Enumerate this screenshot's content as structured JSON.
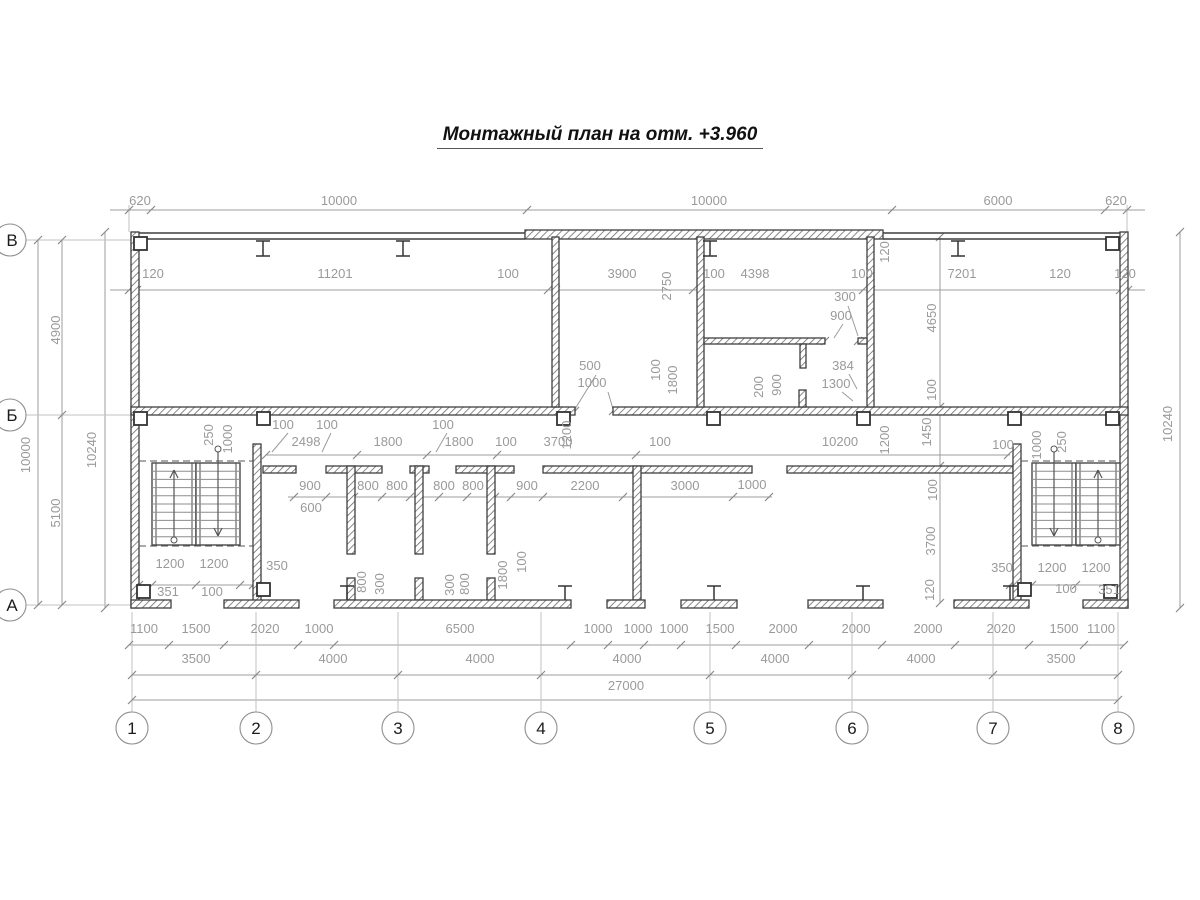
{
  "title": "Монтажный план на отм. +3.960",
  "colors": {
    "wall": "#3f3f3f",
    "dim": "#9c9c9c",
    "dim_text": "#9a9a9a",
    "bubble_stroke": "#8f8f8f",
    "bubble_text": "#1c1c1c",
    "stair": "#4a4a4a"
  },
  "axes": {
    "columns": [
      {
        "label": "1",
        "x": 132
      },
      {
        "label": "2",
        "x": 256
      },
      {
        "label": "3",
        "x": 398
      },
      {
        "label": "4",
        "x": 541
      },
      {
        "label": "5",
        "x": 710
      },
      {
        "label": "6",
        "x": 852
      },
      {
        "label": "7",
        "x": 993
      },
      {
        "label": "8",
        "x": 1118
      }
    ],
    "rows": [
      {
        "label": "В",
        "y": 240
      },
      {
        "label": "Б",
        "y": 415
      },
      {
        "label": "А",
        "y": 605
      }
    ],
    "bubble_row_y": 728,
    "bubble_col_x": 10,
    "bubble_r": 16
  },
  "dimension_labels": [
    [
      "620",
      140,
      205,
      0
    ],
    [
      "10000",
      339,
      205,
      0
    ],
    [
      "10000",
      709,
      205,
      0
    ],
    [
      "6000",
      998,
      205,
      0
    ],
    [
      "620",
      1116,
      205,
      0
    ],
    [
      "120",
      153,
      278,
      0
    ],
    [
      "11201",
      335,
      278,
      0
    ],
    [
      "100",
      508,
      278,
      0
    ],
    [
      "3900",
      622,
      278,
      0
    ],
    [
      "100",
      714,
      278,
      0
    ],
    [
      "4398",
      755,
      278,
      0
    ],
    [
      "100",
      862,
      278,
      0
    ],
    [
      "7201",
      962,
      278,
      0
    ],
    [
      "120",
      1060,
      278,
      0
    ],
    [
      "120",
      1125,
      278,
      0
    ],
    [
      "2750",
      671,
      286,
      1
    ],
    [
      "120",
      889,
      252,
      1
    ],
    [
      "300",
      845,
      301,
      0
    ],
    [
      "900",
      841,
      320,
      0
    ],
    [
      "100",
      660,
      370,
      1
    ],
    [
      "1800",
      677,
      380,
      1
    ],
    [
      "500",
      590,
      370,
      0
    ],
    [
      "1000",
      592,
      387,
      0
    ],
    [
      "200",
      763,
      387,
      1
    ],
    [
      "900",
      781,
      385,
      1
    ],
    [
      "384",
      843,
      370,
      0
    ],
    [
      "1300",
      836,
      388,
      0
    ],
    [
      "4900",
      60,
      330,
      1
    ],
    [
      "10000",
      30,
      455,
      1
    ],
    [
      "10240",
      96,
      450,
      1
    ],
    [
      "5100",
      60,
      513,
      1
    ],
    [
      "10240",
      1172,
      424,
      1
    ],
    [
      "4650",
      936,
      318,
      1
    ],
    [
      "100",
      936,
      390,
      1
    ],
    [
      "1450",
      931,
      432,
      1
    ],
    [
      "100",
      937,
      490,
      1
    ],
    [
      "3700",
      935,
      541,
      1
    ],
    [
      "120",
      934,
      590,
      1
    ],
    [
      "100",
      283,
      429,
      0
    ],
    [
      "100",
      327,
      429,
      0
    ],
    [
      "2498",
      306,
      446,
      0
    ],
    [
      "1800",
      388,
      446,
      0
    ],
    [
      "100",
      443,
      429,
      0
    ],
    [
      "1800",
      459,
      446,
      0
    ],
    [
      "100",
      506,
      446,
      0
    ],
    [
      "3700",
      558,
      446,
      0
    ],
    [
      "100",
      660,
      446,
      0
    ],
    [
      "10200",
      840,
      446,
      0
    ],
    [
      "100",
      1003,
      449,
      0
    ],
    [
      "250",
      213,
      435,
      1
    ],
    [
      "1000",
      232,
      439,
      1
    ],
    [
      "1200",
      571,
      435,
      1
    ],
    [
      "1200",
      889,
      440,
      1
    ],
    [
      "1000",
      1041,
      445,
      1
    ],
    [
      "250",
      1066,
      442,
      1
    ],
    [
      "900",
      310,
      490,
      0
    ],
    [
      "800",
      368,
      490,
      0
    ],
    [
      "800",
      397,
      490,
      0
    ],
    [
      "800",
      444,
      490,
      0
    ],
    [
      "800",
      473,
      490,
      0
    ],
    [
      "900",
      527,
      490,
      0
    ],
    [
      "2200",
      585,
      490,
      0
    ],
    [
      "3000",
      685,
      490,
      0
    ],
    [
      "1000",
      752,
      489,
      0
    ],
    [
      "600",
      311,
      512,
      0
    ],
    [
      "800",
      366,
      582,
      1
    ],
    [
      "300",
      384,
      584,
      1
    ],
    [
      "300",
      454,
      585,
      1
    ],
    [
      "800",
      469,
      584,
      1
    ],
    [
      "1800",
      507,
      575,
      1
    ],
    [
      "100",
      526,
      562,
      1
    ],
    [
      "1200",
      170,
      568,
      0
    ],
    [
      "1200",
      214,
      568,
      0
    ],
    [
      "350",
      277,
      570,
      0
    ],
    [
      "351",
      168,
      596,
      0
    ],
    [
      "100",
      212,
      596,
      0
    ],
    [
      "350",
      1002,
      572,
      0
    ],
    [
      "1200",
      1052,
      572,
      0
    ],
    [
      "1200",
      1096,
      572,
      0
    ],
    [
      "100",
      1066,
      593,
      0
    ],
    [
      "351",
      1109,
      594,
      0
    ],
    [
      "1100",
      144,
      633,
      0
    ],
    [
      "1500",
      196,
      633,
      0
    ],
    [
      "2020",
      265,
      633,
      0
    ],
    [
      "1000",
      319,
      633,
      0
    ],
    [
      "6500",
      460,
      633,
      0
    ],
    [
      "1000",
      598,
      633,
      0
    ],
    [
      "1000",
      638,
      633,
      0
    ],
    [
      "1000",
      674,
      633,
      0
    ],
    [
      "1500",
      720,
      633,
      0
    ],
    [
      "2000",
      783,
      633,
      0
    ],
    [
      "2000",
      856,
      633,
      0
    ],
    [
      "2000",
      928,
      633,
      0
    ],
    [
      "2020",
      1001,
      633,
      0
    ],
    [
      "1500",
      1064,
      633,
      0
    ],
    [
      "1100",
      1101,
      633,
      0
    ],
    [
      "3500",
      196,
      663,
      0
    ],
    [
      "4000",
      333,
      663,
      0
    ],
    [
      "4000",
      480,
      663,
      0
    ],
    [
      "4000",
      627,
      663,
      0
    ],
    [
      "4000",
      775,
      663,
      0
    ],
    [
      "4000",
      921,
      663,
      0
    ],
    [
      "3500",
      1061,
      663,
      0
    ],
    [
      "27000",
      626,
      690,
      0
    ]
  ],
  "dim_lines_h": [
    [
      110,
      1145,
      210
    ],
    [
      110,
      1145,
      290
    ],
    [
      266,
      1010,
      455
    ],
    [
      288,
      772,
      497
    ],
    [
      139,
      253,
      585
    ],
    [
      1010,
      1124,
      585
    ],
    [
      129,
      1124,
      645
    ],
    [
      132,
      1118,
      675
    ],
    [
      132,
      1118,
      700
    ]
  ],
  "dim_lines_v": [
    [
      240,
      605,
      38
    ],
    [
      240,
      605,
      62
    ],
    [
      232,
      608,
      105
    ],
    [
      232,
      608,
      1180
    ],
    [
      237,
      603,
      940
    ]
  ],
  "ticks": [
    [
      129,
      210
    ],
    [
      151,
      210
    ],
    [
      527,
      210
    ],
    [
      892,
      210
    ],
    [
      1105,
      210
    ],
    [
      1127,
      210
    ],
    [
      129,
      290
    ],
    [
      137,
      290
    ],
    [
      548,
      290
    ],
    [
      556,
      290
    ],
    [
      693,
      290
    ],
    [
      701,
      290
    ],
    [
      863,
      290
    ],
    [
      871,
      290
    ],
    [
      1120,
      290
    ],
    [
      1128,
      290
    ],
    [
      266,
      455
    ],
    [
      357,
      455
    ],
    [
      427,
      455
    ],
    [
      497,
      455
    ],
    [
      636,
      455
    ],
    [
      1008,
      455
    ],
    [
      294,
      497
    ],
    [
      326,
      497
    ],
    [
      354,
      497
    ],
    [
      382,
      497
    ],
    [
      410,
      497
    ],
    [
      439,
      497
    ],
    [
      467,
      497
    ],
    [
      495,
      497
    ],
    [
      511,
      497
    ],
    [
      543,
      497
    ],
    [
      623,
      497
    ],
    [
      733,
      497
    ],
    [
      769,
      497
    ],
    [
      139,
      585
    ],
    [
      152,
      585
    ],
    [
      196,
      585
    ],
    [
      240,
      585
    ],
    [
      253,
      585
    ],
    [
      1010,
      585
    ],
    [
      1032,
      585
    ],
    [
      1076,
      585
    ],
    [
      1120,
      585
    ],
    [
      129,
      645
    ],
    [
      169,
      645
    ],
    [
      224,
      645
    ],
    [
      298,
      645
    ],
    [
      334,
      645
    ],
    [
      571,
      645
    ],
    [
      608,
      645
    ],
    [
      644,
      645
    ],
    [
      681,
      645
    ],
    [
      736,
      645
    ],
    [
      809,
      645
    ],
    [
      882,
      645
    ],
    [
      955,
      645
    ],
    [
      1029,
      645
    ],
    [
      1084,
      645
    ],
    [
      1124,
      645
    ],
    [
      132,
      675
    ],
    [
      256,
      675
    ],
    [
      398,
      675
    ],
    [
      541,
      675
    ],
    [
      710,
      675
    ],
    [
      852,
      675
    ],
    [
      993,
      675
    ],
    [
      1118,
      675
    ],
    [
      132,
      700
    ],
    [
      1118,
      700
    ],
    [
      38,
      240
    ],
    [
      38,
      605
    ],
    [
      62,
      240
    ],
    [
      62,
      415
    ],
    [
      62,
      605
    ],
    [
      105,
      232
    ],
    [
      105,
      608
    ],
    [
      1180,
      232
    ],
    [
      1180,
      608
    ],
    [
      940,
      237
    ],
    [
      940,
      407
    ],
    [
      940,
      466
    ],
    [
      940,
      603
    ],
    [
      575,
      411
    ],
    [
      613,
      411
    ],
    [
      825,
      341
    ],
    [
      858,
      341
    ]
  ],
  "leader_lines": [
    [
      596,
      375,
      575,
      409
    ],
    [
      608,
      392,
      613,
      409
    ],
    [
      848,
      306,
      858,
      336
    ],
    [
      843,
      324,
      834,
      338
    ],
    [
      288,
      433,
      272,
      452
    ],
    [
      331,
      433,
      322,
      452
    ],
    [
      447,
      433,
      436,
      452
    ],
    [
      849,
      374,
      857,
      389
    ],
    [
      842,
      392,
      853,
      401
    ]
  ],
  "walls": [
    [
      131,
      232,
      8,
      376
    ],
    [
      1120,
      232,
      8,
      376
    ],
    [
      525,
      230,
      358,
      9
    ],
    [
      131,
      407,
      444,
      8
    ],
    [
      613,
      407,
      515,
      8
    ],
    [
      552,
      237,
      7,
      170
    ],
    [
      697,
      237,
      7,
      170
    ],
    [
      867,
      237,
      7,
      170
    ],
    [
      704,
      338,
      121,
      6
    ],
    [
      858,
      338,
      9,
      6
    ],
    [
      800,
      344,
      6,
      24
    ],
    [
      799,
      390,
      7,
      17
    ],
    [
      263,
      466,
      33,
      7
    ],
    [
      326,
      466,
      56,
      7
    ],
    [
      410,
      466,
      19,
      7
    ],
    [
      456,
      466,
      58,
      7
    ],
    [
      543,
      466,
      209,
      7
    ],
    [
      787,
      466,
      226,
      7
    ],
    [
      347,
      466,
      8,
      88
    ],
    [
      347,
      578,
      8,
      22
    ],
    [
      415,
      466,
      8,
      88
    ],
    [
      415,
      578,
      8,
      22
    ],
    [
      487,
      466,
      8,
      88
    ],
    [
      487,
      578,
      8,
      22
    ],
    [
      633,
      466,
      8,
      134
    ],
    [
      253,
      444,
      8,
      159
    ],
    [
      1013,
      444,
      8,
      159
    ],
    [
      131,
      600,
      40,
      8
    ],
    [
      224,
      600,
      75,
      8
    ],
    [
      334,
      600,
      237,
      8
    ],
    [
      607,
      600,
      38,
      8
    ],
    [
      681,
      600,
      56,
      8
    ],
    [
      808,
      600,
      75,
      8
    ],
    [
      954,
      600,
      75,
      8
    ],
    [
      1083,
      600,
      45,
      8
    ]
  ],
  "wall_lines": [
    [
      139,
      233,
      525,
      233
    ],
    [
      139,
      239,
      525,
      239
    ],
    [
      883,
      233,
      1120,
      233
    ],
    [
      883,
      239,
      1120,
      239
    ]
  ],
  "squares": [
    [
      134,
      237
    ],
    [
      1106,
      237
    ],
    [
      134,
      412
    ],
    [
      257,
      412
    ],
    [
      557,
      412
    ],
    [
      707,
      412
    ],
    [
      857,
      412
    ],
    [
      1008,
      412
    ],
    [
      1106,
      412
    ],
    [
      137,
      585
    ],
    [
      257,
      583
    ],
    [
      1018,
      583
    ],
    [
      1104,
      585
    ]
  ],
  "ibeams_top": [
    263,
    403,
    710,
    958
  ],
  "ibeams_bottom": [
    347,
    565,
    714,
    863,
    1010
  ],
  "stairs": {
    "flights": [
      [
        152,
        463,
        44,
        82
      ],
      [
        196,
        463,
        44,
        82
      ],
      [
        1032,
        463,
        44,
        82
      ],
      [
        1076,
        463,
        44,
        82
      ]
    ],
    "dashed": [
      [
        139,
        461,
        253,
        461
      ],
      [
        139,
        546,
        253,
        546
      ],
      [
        1021,
        461,
        1120,
        461
      ],
      [
        1021,
        546,
        1120,
        546
      ]
    ],
    "arrows": [
      [
        174,
        540,
        470
      ],
      [
        218,
        449,
        536
      ],
      [
        1054,
        449,
        536
      ],
      [
        1098,
        540,
        470
      ]
    ],
    "treads": 10
  }
}
